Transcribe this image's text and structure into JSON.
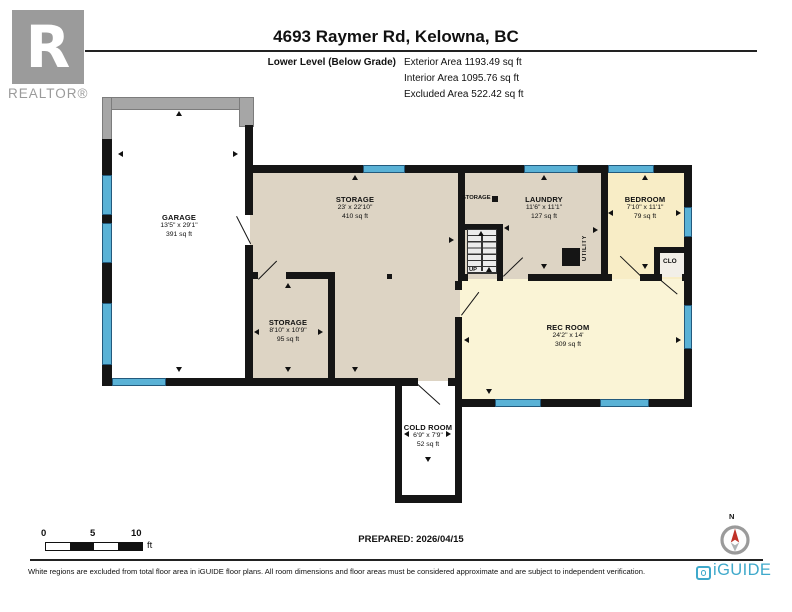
{
  "header": {
    "logo_text": "R",
    "logo_caption": "REALTOR®",
    "title": "4693 Raymer Rd, Kelowna, BC",
    "level_label": "Lower Level (Below Grade)",
    "area_lines": [
      "Exterior Area 1193.49 sq ft",
      "Interior Area 1095.76 sq ft",
      "Excluded Area 522.42 sq ft"
    ]
  },
  "rooms": [
    {
      "name": "GARAGE",
      "dims": "13'5\" x 29'1\"",
      "area": "391 sq ft"
    },
    {
      "name": "STORAGE",
      "dims": "23' x 22'10\"",
      "area": "410 sq ft"
    },
    {
      "name": "STORAGE",
      "dims": "8'10\" x 10'9\"",
      "area": "95 sq ft"
    },
    {
      "name": "LAUNDRY",
      "dims": "11'6\" x 11'1\"",
      "area": "127 sq ft"
    },
    {
      "name": "BEDROOM",
      "dims": "7'10\" x 11'1\"",
      "area": "79 sq ft"
    },
    {
      "name": "REC ROOM",
      "dims": "24'2\" x 14'",
      "area": "309 sq ft"
    },
    {
      "name": "COLD ROOM",
      "dims": "6'9\" x 7'9\"",
      "area": "52 sq ft"
    }
  ],
  "plan_labels": {
    "corridor_storage": "STORAGE",
    "utility": "UTILITY",
    "closet": "CLO",
    "stairs_up": "UP"
  },
  "scale_bar": {
    "ticks": [
      "0",
      "5",
      "10"
    ],
    "unit": "ft"
  },
  "compass": {
    "north_label": "N"
  },
  "footer": {
    "prepared": "PREPARED: 2026/04/15",
    "disclaimer": "White regions are excluded from total floor area in iGUIDE floor plans. All room dimensions and floor areas must be considered approximate and are subject to independent verification.",
    "brand": "iGUIDE"
  },
  "colors": {
    "wall": "#151515",
    "excluded_wall": "#a6a6a6",
    "window": "#5ab2d6",
    "interior_floor": "#ddd4c4",
    "rec_room_floor": "#faf4d6",
    "bedroom_floor": "#f8edc6",
    "excluded_floor": "#ffffff",
    "brand_blue": "#3fa9cb",
    "compass_red": "#c03127",
    "logo_gray": "#9b9b9b"
  }
}
